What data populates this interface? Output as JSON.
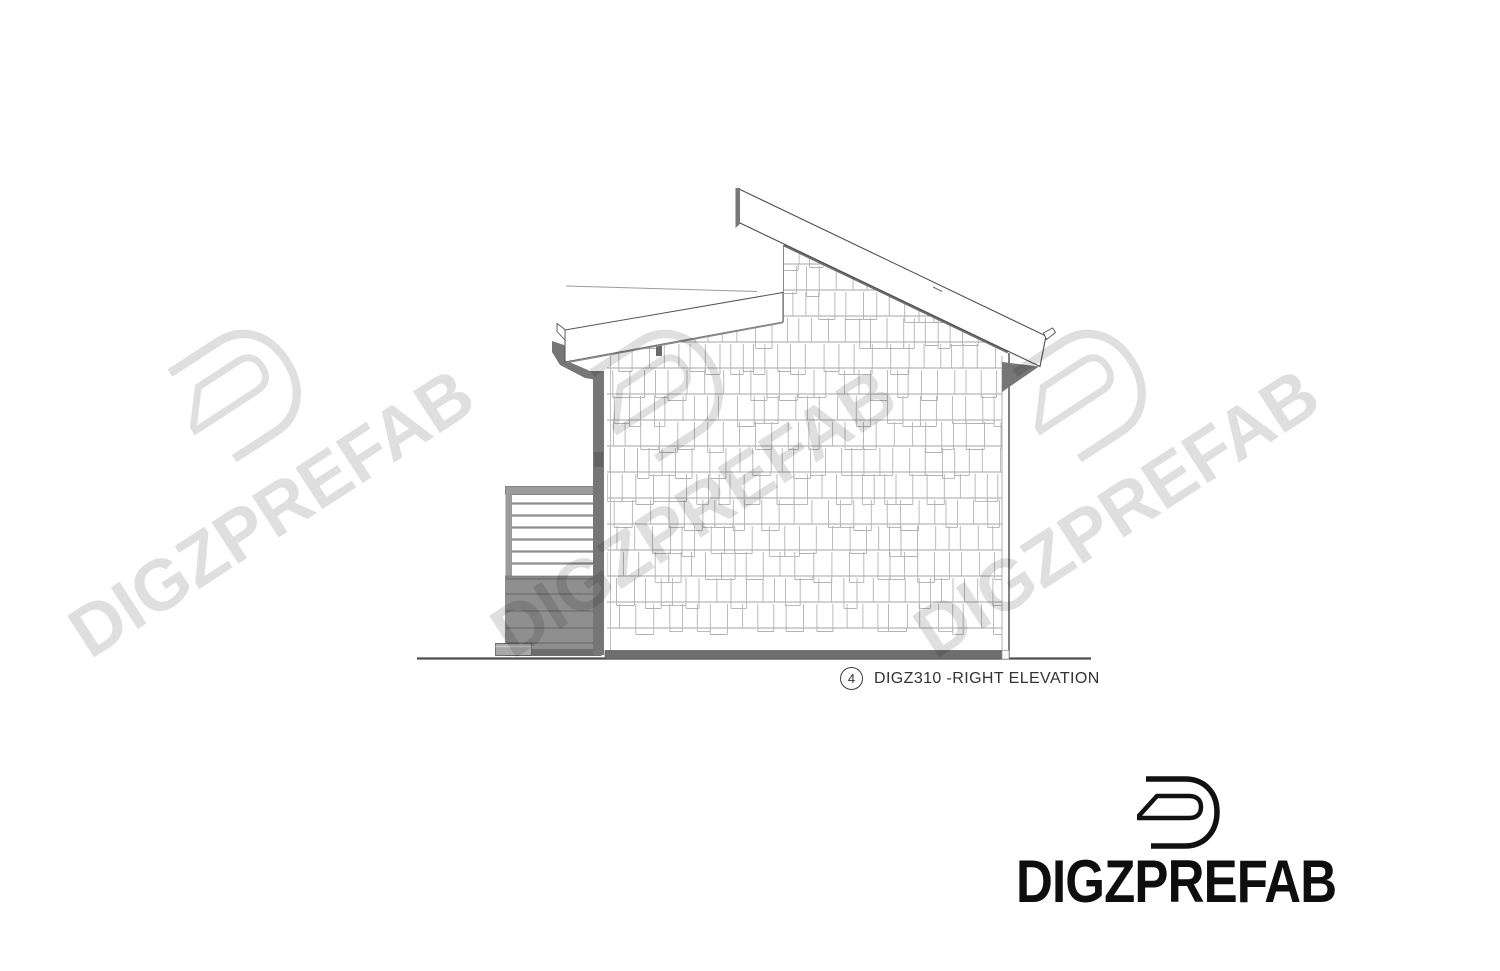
{
  "page": {
    "width": 1500,
    "height": 971,
    "background": "#ffffff"
  },
  "caption": {
    "number": "4",
    "label": "DIGZ310 -RIGHT ELEVATION"
  },
  "brand": {
    "wordmark": "DIGZPREFAB",
    "logo_icon": "digz-d-logo"
  },
  "watermark": {
    "text": "DIGZPREFAB",
    "logo_icon": "digz-d-logo",
    "instances": 3,
    "angle_deg": -33,
    "color": "rgba(0,0,0,0.125)"
  },
  "drawing": {
    "name": "right-elevation",
    "view": "Right side elevation of DIGZ310 prefab unit with clerestory shed roof, shingle siding, deck guardrail, skirt, step, gutter and downspout",
    "colors": {
      "background": "#ffffff",
      "line": "#4d4d4d",
      "shingle_line": "#b3b3b3",
      "shingle_row": "#a6a6a6",
      "metal_gray": "#767676",
      "deck_gray": "#8f8f8f",
      "deck_line": "#6d6d6d",
      "base_gray": "#6e6e6e",
      "caption_text": "#333333",
      "brand_black": "#0e0e0e"
    },
    "shingles": {
      "row_height": 26,
      "min_width": 10,
      "max_width": 19,
      "top": 238,
      "bottom": 652,
      "left": 604,
      "right": 1010,
      "seed": 7
    }
  }
}
